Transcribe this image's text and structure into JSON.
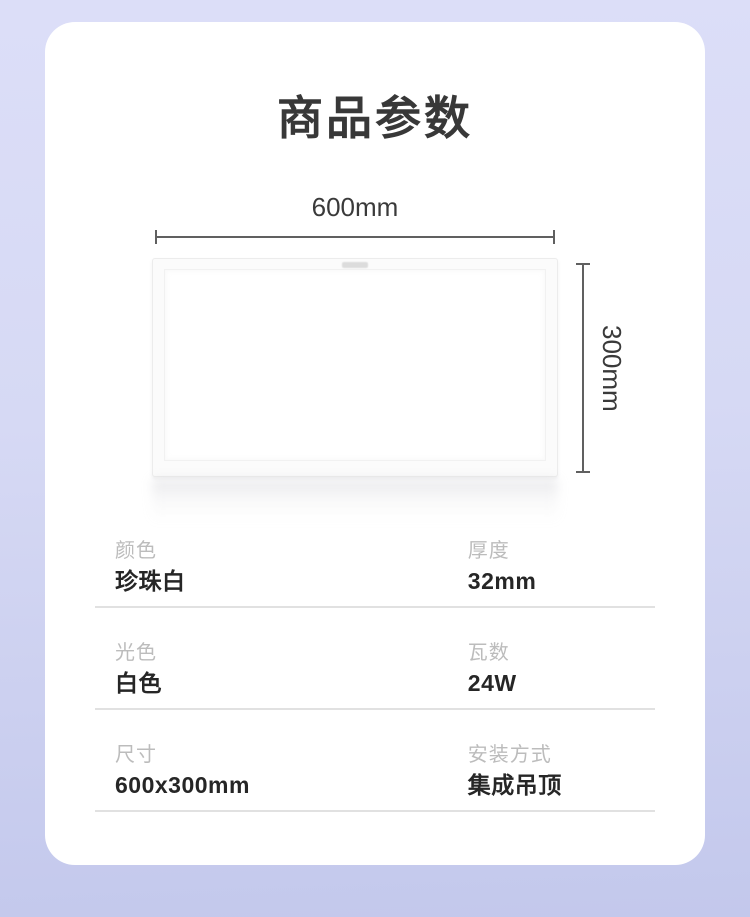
{
  "page": {
    "title": "商品参数"
  },
  "diagram": {
    "width_label": "600mm",
    "height_label": "300mm",
    "logo": "brand-logo-mark"
  },
  "specs": {
    "rows": [
      {
        "left": {
          "label": "颜色",
          "value": "珍珠白"
        },
        "right": {
          "label": "厚度",
          "value": "32mm"
        }
      },
      {
        "left": {
          "label": "光色",
          "value": "白色"
        },
        "right": {
          "label": "瓦数",
          "value": "24W"
        }
      },
      {
        "left": {
          "label": "尺寸",
          "value": "600x300mm"
        },
        "right": {
          "label": "安装方式",
          "value": "集成吊顶"
        }
      }
    ]
  },
  "colors": {
    "background_top": "#dcdef8",
    "background_bottom": "#c3c8ec",
    "card": "#ffffff",
    "title_text": "#383838",
    "label_text": "#bcbcbc",
    "value_text": "#262626",
    "dimension_line": "#606060",
    "divider": "#e1e1e1"
  }
}
